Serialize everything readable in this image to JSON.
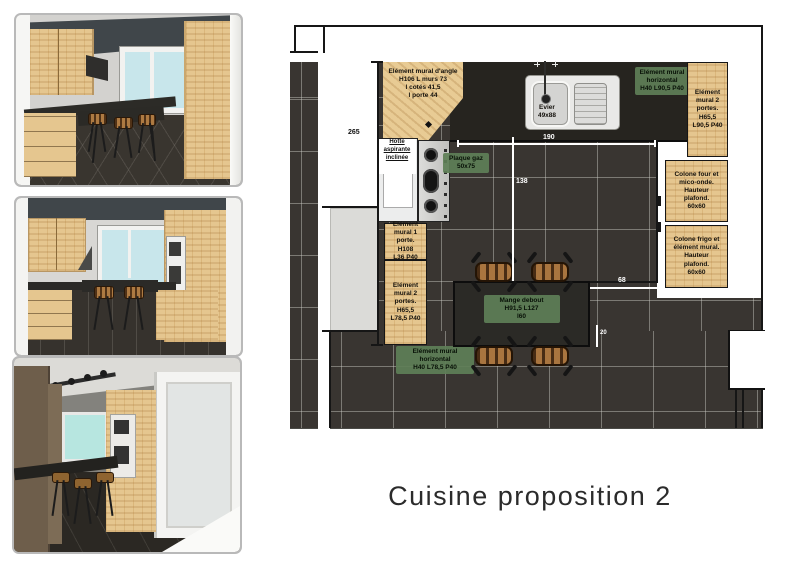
{
  "title": "Cuisine proposition 2",
  "plan": {
    "dimensions": {
      "wall_height": "265",
      "opening_width": "190",
      "floor_depth": "138",
      "table_gap": "68",
      "table_offset": "20"
    },
    "labels": {
      "corner_cabinet": "Elément mural d'angle\nH106 L murs 73\nl cotés 41,5\nl porte 44",
      "hood": "Hotte\naspirante\ninclinée",
      "hob": "Plaque gaz\n50x75",
      "sink": "Evier\n49x88",
      "wall_unit_horizontal_right": "Elément mural\nhorizontal\nH40 L90,5 P40",
      "wall_unit_2_doors_right": "Elément\nmural 2\nportes.\nH65,5\nL90,5 P40",
      "column_oven_microwave": "Colone four et\nmico-onde.\nHauteur\nplafond.\n60x60",
      "column_fridge": "Colone frigo et\nélément mural.\nHauteur\nplafond.\n60x60",
      "wall_unit_1_door_left": "Elément\nmural 1 porte.\nH108\nL36 P40",
      "wall_unit_2_doors_left": "Elément\nmural 2\nportes.\nH65,5\nL78,5 P40",
      "wall_unit_horizontal_bottom": "Elément mural\nhorizontal\nH40 L78,5 P40",
      "standing_table": "Mange debout\nH91,5 L127\nl60"
    },
    "colors": {
      "floor_tile": "#393531",
      "worktop": "#26241f",
      "wood": "#e5c68f",
      "label_green": "#5e7f57"
    }
  }
}
